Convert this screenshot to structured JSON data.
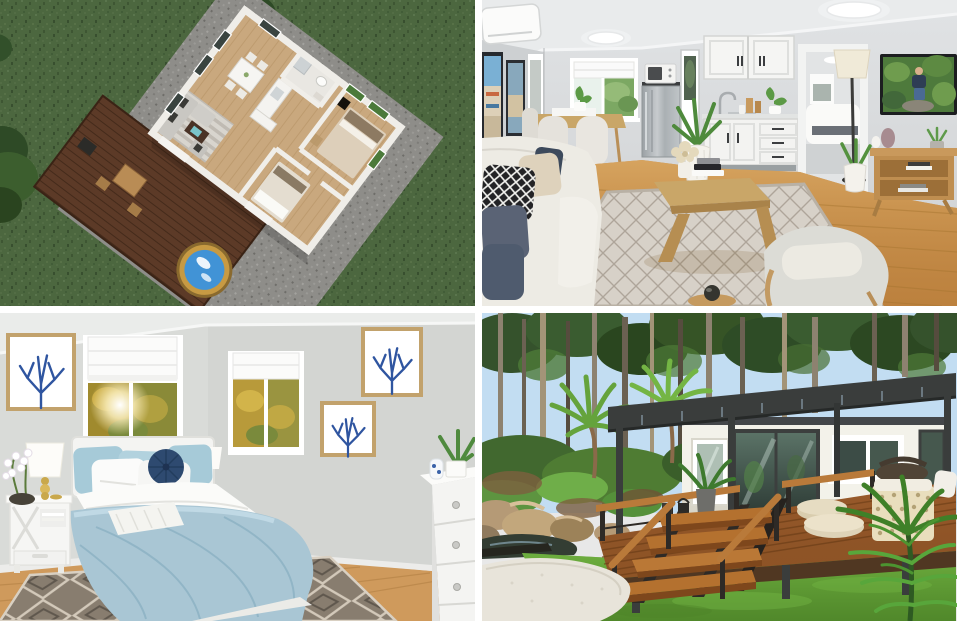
{
  "page": {
    "type": "property-photo-collage",
    "background": "#ffffff",
    "rows": 2,
    "cols": 2,
    "gutter_px": 7
  },
  "gallery": {
    "images": [
      {
        "alt": "Aerial 3D floor-plan render of a two-bedroom granny flat on a green lawn with gravel pad, timber deck, outdoor dining table and round plunge pool"
      },
      {
        "alt": "Interior render of open-plan living room and white kitchenette with dining nook, stainless fridge, TV and cream sofa on lattice rug"
      },
      {
        "alt": "Bedroom render with light-blue bedding, white nightstand, blue coral wall art, two sunny windows and grey diamond rug"
      },
      {
        "alt": "Exterior render of a white cabin with dark pergola, timber deck and stairs, surrounded by forest, palms, rocks, lawn and a curved gravel path"
      }
    ]
  },
  "palette": {
    "s1_grass": "#4c673f",
    "s1_gravel": "#8e8d89",
    "s1_floor": "#c9a87e",
    "s1_wall": "#efede8",
    "s1_deck": "#5c3a27",
    "s1_pool": "#4193d6",
    "s1_pool_rim": "#c79a43",
    "s1_tree": "#2e4a26",
    "s2_wall": "#d7dadc",
    "s2_ceiling": "#e9ebec",
    "s2_floor": "#c68d4d",
    "s2_rug": "#d7d1c8",
    "s2_sofa": "#edebe4",
    "s2_table": "#c9a668",
    "s2_fridge": "#b2b7ba",
    "s3_wall": "#d9dbd8",
    "s3_duvet": "#a9c6d4",
    "s3_rug": "#887d6f",
    "s3_floor": "#cf9a5c",
    "s3_navy": "#2e4a70",
    "s3_coral_blue": "#2f55a0",
    "s4_sky": "#c2ddf2",
    "s4_canopy": "#35522c",
    "s4_lawn": "#5f9c33",
    "s4_path": "#e8e4da",
    "s4_deck": "#9c5c2b",
    "s4_pergola": "#3a3d3c",
    "s4_facade": "#f3f2ea",
    "s4_palm": "#4c8f2f"
  }
}
